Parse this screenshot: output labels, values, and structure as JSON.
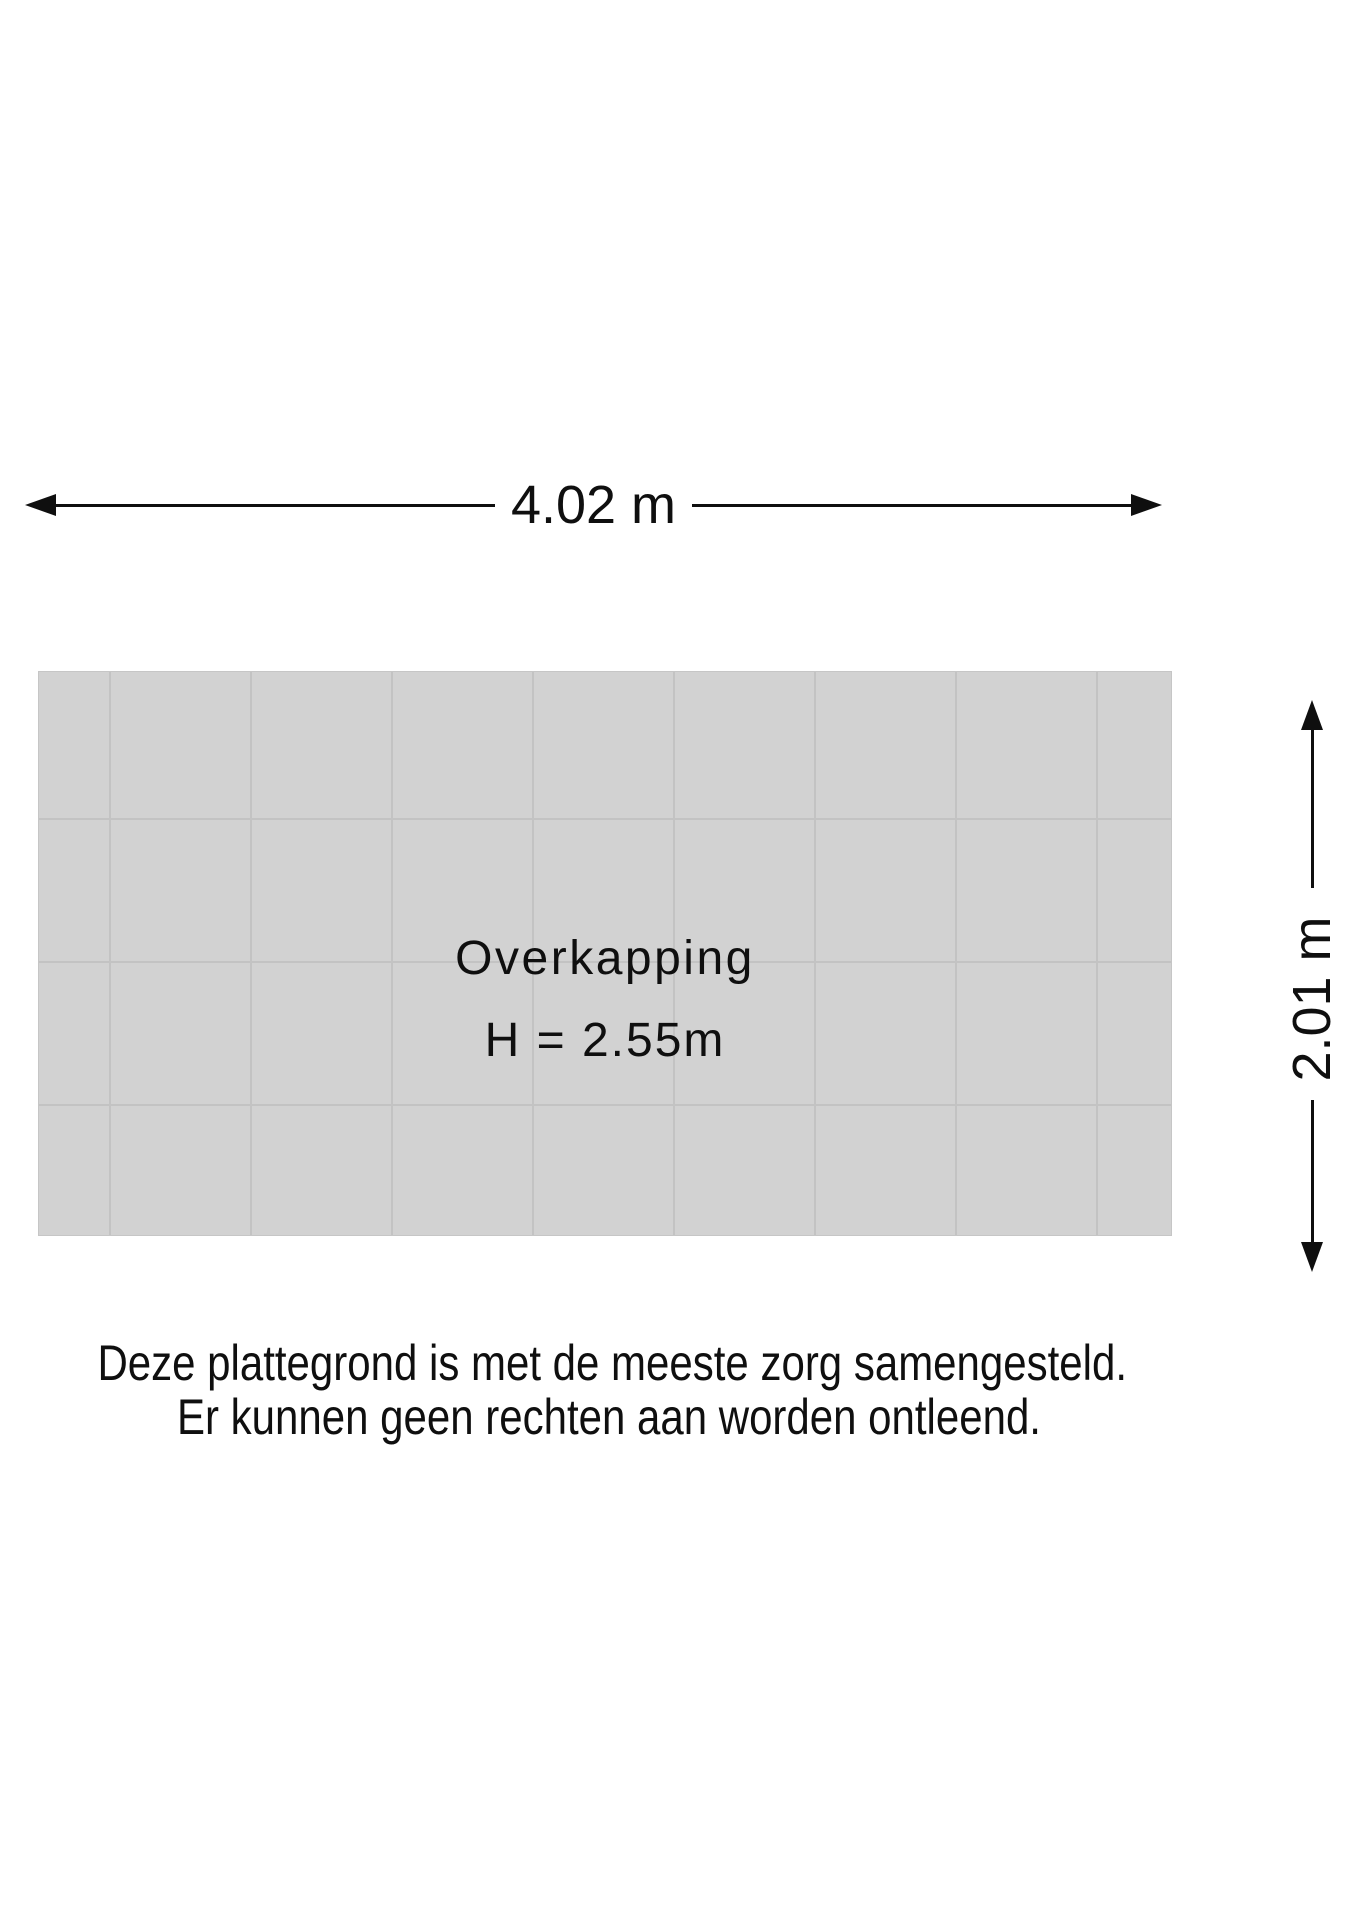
{
  "dimensions": {
    "width": {
      "label": "4.02 m"
    },
    "height": {
      "label": "2.01 m"
    }
  },
  "room": {
    "name": "Overkapping",
    "height_label": "H = 2.55m"
  },
  "disclaimer": {
    "line1": "Deze plattegrond is met de meeste zorg samengesteld.",
    "line2": "Er kunnen geen rechten aan worden ontleend."
  },
  "colors": {
    "ink": "#0f0f0f",
    "floor_fill": "#d2d2d2",
    "floor_grid_line": "#c3c3c3",
    "floor_edge": "#c6c6c6"
  }
}
